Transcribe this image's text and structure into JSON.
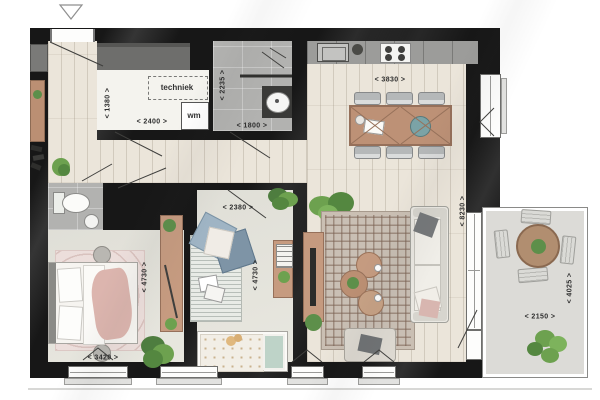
{
  "plan": {
    "room_labels": {
      "techniek": "techniek",
      "wm": "wm"
    },
    "dimensions": [
      {
        "id": "hall-1380",
        "text": "< 1380 >",
        "x": 108,
        "y": 103,
        "vertical": true
      },
      {
        "id": "techniek-2400",
        "text": "< 2400 >",
        "x": 152,
        "y": 122,
        "vertical": false
      },
      {
        "id": "bathroom-2235",
        "text": "< 2235 >",
        "x": 223,
        "y": 85,
        "vertical": true
      },
      {
        "id": "bathroom-1800",
        "text": "< 1800 >",
        "x": 252,
        "y": 126,
        "vertical": false
      },
      {
        "id": "kitchen-3830",
        "text": "< 3830 >",
        "x": 390,
        "y": 80,
        "vertical": false
      },
      {
        "id": "bedroom2-2380",
        "text": "< 2380 >",
        "x": 238,
        "y": 208,
        "vertical": false
      },
      {
        "id": "bedroom1-4730",
        "text": "< 4730 >",
        "x": 145,
        "y": 277,
        "vertical": true
      },
      {
        "id": "bedroom2-4730",
        "text": "< 4730 >",
        "x": 256,
        "y": 275,
        "vertical": true
      },
      {
        "id": "living-8230",
        "text": "< 8230 >",
        "x": 463,
        "y": 211,
        "vertical": true
      },
      {
        "id": "bedroom1-3420",
        "text": "< 3420 >",
        "x": 103,
        "y": 358,
        "vertical": false
      },
      {
        "id": "balcony-2150",
        "text": "< 2150 >",
        "x": 540,
        "y": 317,
        "vertical": false
      },
      {
        "id": "balcony-4025",
        "text": "< 4025 >",
        "x": 570,
        "y": 288,
        "vertical": true
      }
    ],
    "palette": {
      "wall": "#171717",
      "wood_floor": "#ebe5da",
      "room_floor": "#e7e6de",
      "tile": "#b2b2b0",
      "counter": "#9c9c9a",
      "wood_furniture": "#bd9176",
      "living_rug": "#c9bfb4",
      "pink_textile": "#d9b7b1",
      "blue_textile": "#8fa6b6",
      "plant_green": "#5d8f4a",
      "balcony_floor": "#dcdbd7"
    }
  }
}
